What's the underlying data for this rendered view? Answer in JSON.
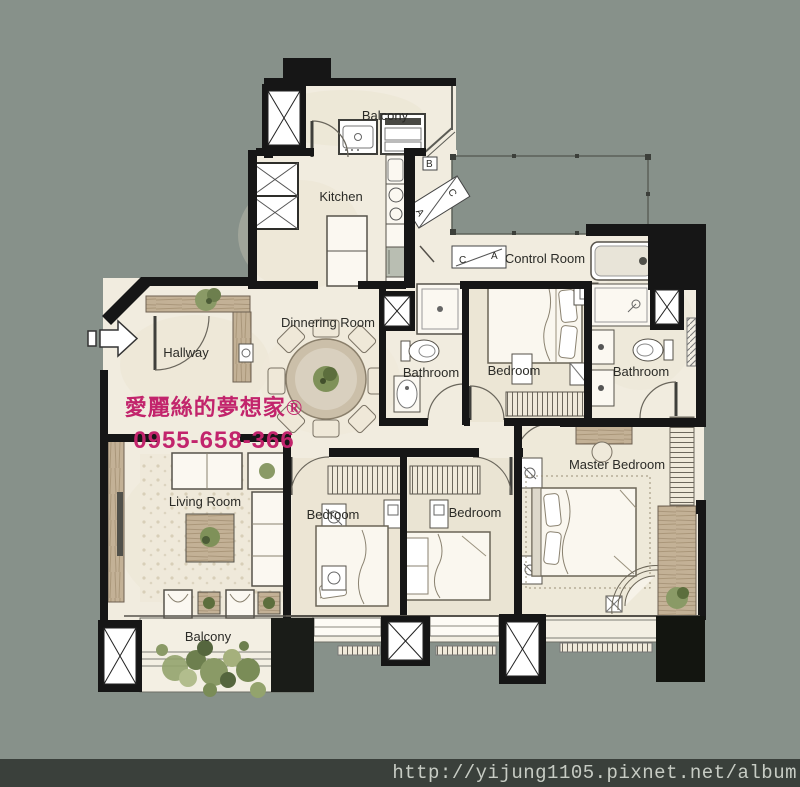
{
  "plan": {
    "rooms": {
      "balcony_top": "Balcony",
      "kitchen": "Kitchen",
      "control_room": "Control Room",
      "dinnering_room": "Dinnering Room",
      "hallway": "Hallway",
      "bathroom_left": "Bathroom",
      "bedroom_top": "Bedroom",
      "bathroom_right": "Bathroom",
      "master_bedroom": "Master Bedroom",
      "living_room": "Living Room",
      "bedroom_bottom_left": "Bedroom",
      "bedroom_bottom_right": "Bedroom",
      "balcony_bottom": "Balcony"
    },
    "duct_labels": {
      "a": "A",
      "b": "B",
      "c": "C"
    },
    "colors": {
      "scan_background": "#87918a",
      "paper": "#f1ecdf",
      "wall": "#161616",
      "wood": "#bfae92",
      "accent_pink": "#c2246c",
      "url_bar": "#3a403b"
    }
  },
  "watermarks": {
    "brand": "愛麗絲的夢想家®",
    "phone": "0955-658-366",
    "url": "http://yijung1105.pixnet.net/album"
  }
}
